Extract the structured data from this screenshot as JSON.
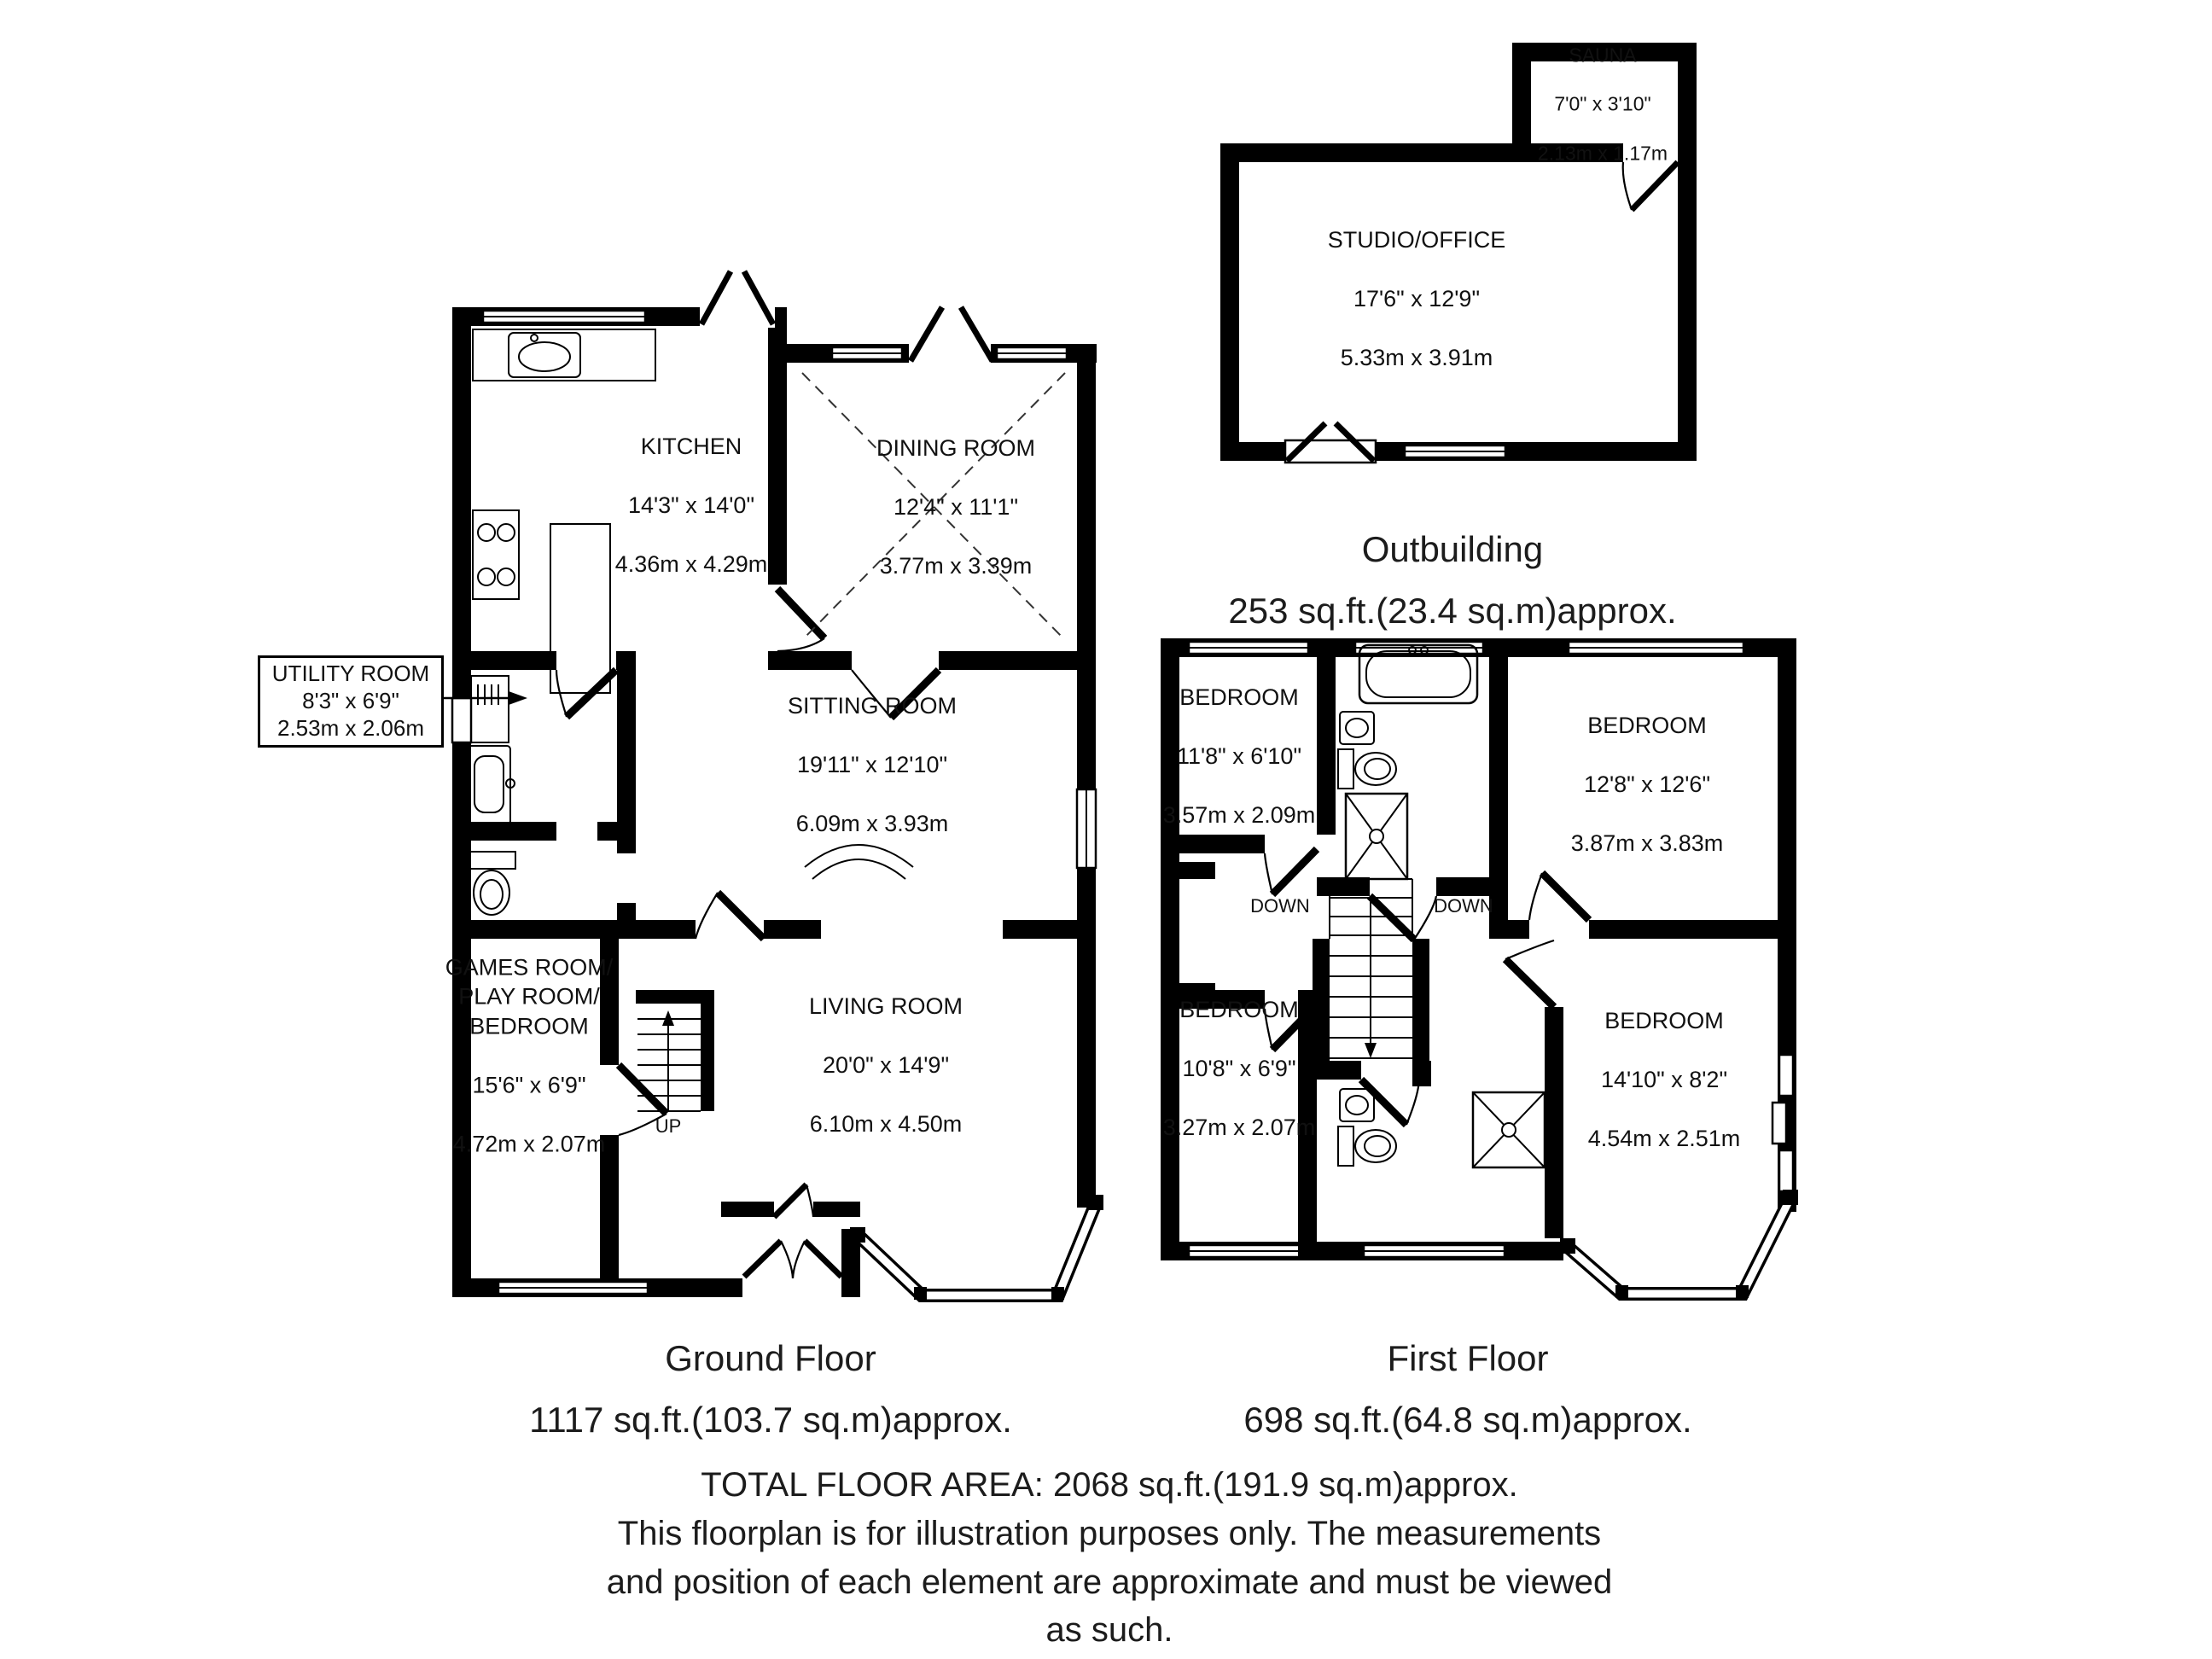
{
  "plan": {
    "wall_color": "#000000",
    "background": "#ffffff",
    "type": "floorplan"
  },
  "ground_floor": {
    "caption": {
      "title": "Ground Floor",
      "area": "1117 sq.ft.(103.7 sq.m)approx."
    },
    "stairs_label": "UP",
    "rooms": {
      "kitchen": {
        "name": "KITCHEN",
        "imperial": "14'3\" x 14'0\"",
        "metric": "4.36m x 4.29m"
      },
      "dining_room": {
        "name": "DINING ROOM",
        "imperial": "12'4\" x 11'1\"",
        "metric": "3.77m x 3.39m"
      },
      "sitting_room": {
        "name": "SITTING ROOM",
        "imperial": "19'11\" x 12'10\"",
        "metric": "6.09m x 3.93m"
      },
      "utility_room": {
        "name": "UTILITY ROOM",
        "imperial": "8'3\" x 6'9\"",
        "metric": "2.53m x 2.06m"
      },
      "games_room": {
        "name": "GAMES ROOM/\nPLAY ROOM/\nBEDROOM",
        "imperial": "15'6\" x 6'9\"",
        "metric": "4.72m x 2.07m"
      },
      "living_room": {
        "name": "LIVING ROOM",
        "imperial": "20'0\" x 14'9\"",
        "metric": "6.10m x 4.50m"
      }
    }
  },
  "first_floor": {
    "caption": {
      "title": "First Floor",
      "area": "698 sq.ft.(64.8 sq.m)approx."
    },
    "stairs_label_left": "DOWN",
    "stairs_label_right": "DOWN",
    "rooms": {
      "bedroom_top_left": {
        "name": "BEDROOM",
        "imperial": "11'8\" x 6'10\"",
        "metric": "3.57m x 2.09m"
      },
      "bedroom_top_right": {
        "name": "BEDROOM",
        "imperial": "12'8\" x 12'6\"",
        "metric": "3.87m x 3.83m"
      },
      "bedroom_bottom_left": {
        "name": "BEDROOM",
        "imperial": "10'8\" x 6'9\"",
        "metric": "3.27m x 2.07m"
      },
      "bedroom_bottom_right": {
        "name": "BEDROOM",
        "imperial": "14'10\" x 8'2\"",
        "metric": "4.54m x 2.51m"
      }
    }
  },
  "outbuilding": {
    "caption": {
      "title": "Outbuilding",
      "area": "253 sq.ft.(23.4 sq.m)approx."
    },
    "rooms": {
      "studio_office": {
        "name": "STUDIO/OFFICE",
        "imperial": "17'6\" x 12'9\"",
        "metric": "5.33m x 3.91m"
      },
      "sauna": {
        "name": "SAUNA",
        "imperial": "7'0\" x 3'10\"",
        "metric": "2.13m x 1.17m"
      }
    }
  },
  "footer": {
    "lines": [
      "TOTAL FLOOR AREA: 2068 sq.ft.(191.9 sq.m)approx.",
      "This floorplan is for illustration purposes only. The measurements",
      "and position of each element are approximate and must be viewed",
      "as such."
    ]
  }
}
